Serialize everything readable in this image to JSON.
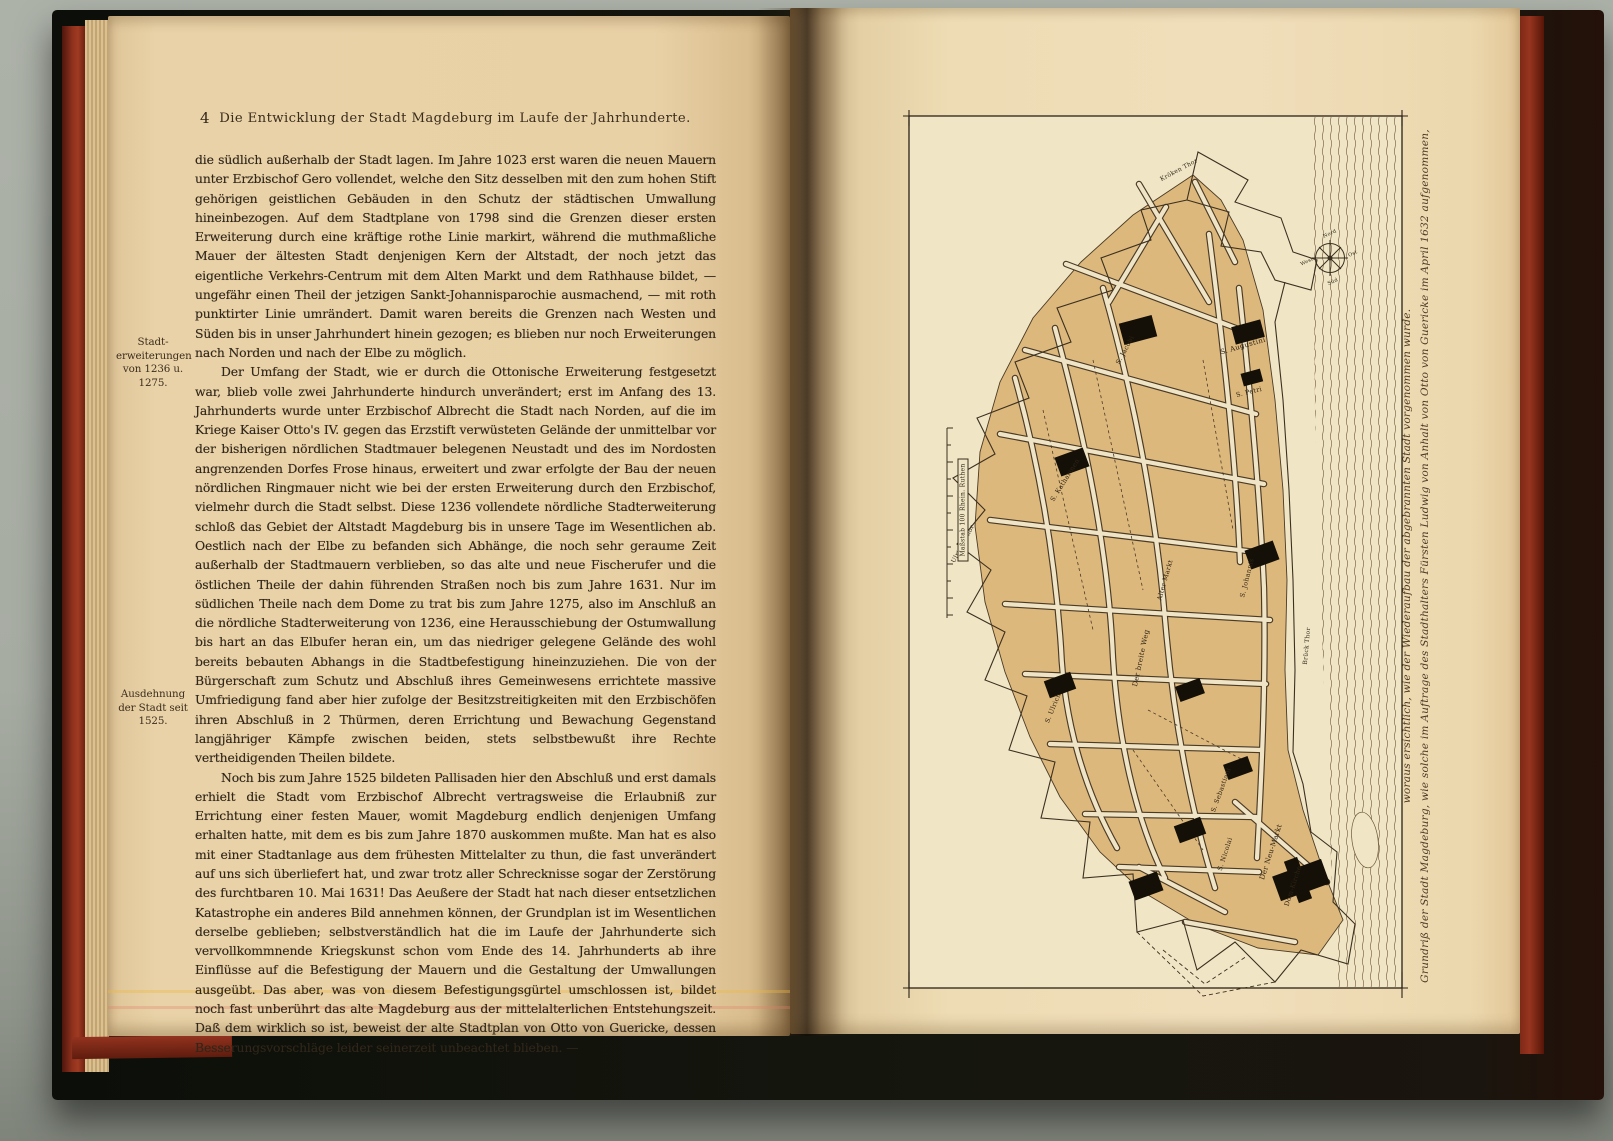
{
  "book": {
    "left_page": {
      "page_number": "4",
      "running_header": "Die Entwicklung der Stadt Magdeburg im Laufe der Jahrhunderte.",
      "margin_notes": [
        {
          "text": "Stadt-erweiterungen von 1236 u. 1275."
        },
        {
          "text": "Ausdehnung der Stadt seit 1525."
        }
      ],
      "paragraphs": [
        "die südlich außerhalb der Stadt lagen. Im Jahre 1023 erst waren die neuen Mauern unter Erzbischof Gero vollendet, welche den Sitz desselben mit den zum hohen Stift gehörigen geistlichen Gebäuden in den Schutz der städtischen Umwallung hineinbezogen. Auf dem Stadtplane von 1798 sind die Grenzen dieser ersten Erweiterung durch eine kräftige rothe Linie markirt, während die muthmaßliche Mauer der ältesten Stadt denjenigen Kern der Altstadt, der noch jetzt das eigentliche Verkehrs-Centrum mit dem Alten Markt und dem Rathhause bildet, — ungefähr einen Theil der jetzigen Sankt-Johannisparochie ausmachend, — mit roth punktirter Linie umrändert. Damit waren bereits die Grenzen nach Westen und Süden bis in unser Jahrhundert hinein gezogen; es blieben nur noch Erweiterungen nach Norden und nach der Elbe zu möglich.",
        "Der Umfang der Stadt, wie er durch die Ottonische Erweiterung festgesetzt war, blieb volle zwei Jahrhunderte hindurch unverändert; erst im Anfang des 13. Jahrhunderts wurde unter Erzbischof Albrecht die Stadt nach Norden, auf die im Kriege Kaiser Otto's IV. gegen das Erzstift verwüsteten Gelände der unmittelbar vor der bisherigen nördlichen Stadtmauer belegenen Neustadt und des im Nordosten angrenzenden Dorfes Frose hinaus, erweitert und zwar erfolgte der Bau der neuen nördlichen Ringmauer nicht wie bei der ersten Erweiterung durch den Erzbischof, vielmehr durch die Stadt selbst. Diese 1236 vollendete nördliche Stadterweiterung schloß das Gebiet der Altstadt Magdeburg bis in unsere Tage im Wesentlichen ab. Oestlich nach der Elbe zu befanden sich Abhänge, die noch sehr geraume Zeit außerhalb der Stadtmauern verblieben, so das alte und neue Fischerufer und die östlichen Theile der dahin führenden Straßen noch bis zum Jahre 1631. Nur im südlichen Theile nach dem Dome zu trat bis zum Jahre 1275, also im Anschluß an die nördliche Stadterweiterung von 1236, eine Herausschiebung der Ostumwallung bis hart an das Elbufer heran ein, um das niedriger gelegene Gelände des wohl bereits bebauten Abhangs in die Stadtbefestigung hineinzuziehen. Die von der Bürgerschaft zum Schutz und Abschluß ihres Gemeinwesens errichtete massive Umfriedigung fand aber hier zufolge der Besitzstreitigkeiten mit den Erzbischöfen ihren Abschluß in 2 Thürmen, deren Errichtung und Bewachung Gegenstand langjähriger Kämpfe zwischen beiden, stets selbstbewußt ihre Rechte vertheidigenden Theilen bildete.",
        "Noch bis zum Jahre 1525 bildeten Pallisaden hier den Abschluß und erst damals erhielt die Stadt vom Erzbischof Albrecht vertragsweise die Erlaubniß zur Errichtung einer festen Mauer, womit Magdeburg endlich denjenigen Umfang erhalten hatte, mit dem es bis zum Jahre 1870 auskommen mußte. Man hat es also mit einer Stadtanlage aus dem frühesten Mittelalter zu thun, die fast unverändert auf uns sich überliefert hat, und zwar trotz aller Schrecknisse sogar der Zerstörung des furchtbaren 10. Mai 1631! Das Aeußere der Stadt hat nach dieser entsetzlichen Katastrophe ein anderes Bild annehmen können, der Grundplan ist im Wesentlichen derselbe geblieben; selbstverständlich hat die im Laufe der Jahrhunderte sich vervollkommnende Kriegskunst schon vom Ende des 14. Jahrhunderts ab ihre Einflüsse auf die Befestigung der Mauern und die Gestaltung der Umwallungen ausgeübt. Das aber, was von diesem Befestigungsgürtel umschlossen ist, bildet noch fast unberührt das alte Magdeburg aus der mittelalterlichen Entstehungszeit. Daß dem wirklich so ist, beweist der alte Stadtplan von Otto von Guericke, dessen Besserungsvorschläge leider seinerzeit unbeachtet blieben. —"
      ]
    },
    "right_page": {
      "map": {
        "caption_line1": "Grundriß der Stadt Magdeburg, wie solche im Auftrage des Stadthalters Fürsten Ludwig von Anhalt von Otto von Guericke im April 1632 aufgenommen,",
        "caption_line2": "woraus ersichtlich, wie der Wiederaufbau der abgebrannten Stadt vorgenommen wurde.",
        "labels": [
          {
            "text": "S. Jacobi",
            "x": 222,
            "y": 240,
            "rot": -62,
            "size": 6.5
          },
          {
            "text": "S. Augustini",
            "x": 340,
            "y": 236,
            "rot": -16,
            "size": 7
          },
          {
            "text": "S. Petri",
            "x": 346,
            "y": 282,
            "rot": -14,
            "size": 6.5
          },
          {
            "text": "S. Katharinen",
            "x": 162,
            "y": 370,
            "rot": -58,
            "size": 6.5
          },
          {
            "text": "S. Johannis",
            "x": 344,
            "y": 468,
            "rot": -76,
            "size": 6.5
          },
          {
            "text": "Alter Markt",
            "x": 262,
            "y": 470,
            "rot": -74,
            "size": 6.5
          },
          {
            "text": "Der breite Weg",
            "x": 238,
            "y": 548,
            "rot": -78,
            "size": 7
          },
          {
            "text": "S. Ulrich",
            "x": 150,
            "y": 598,
            "rot": -68,
            "size": 6.5
          },
          {
            "text": "S. Sebastiani",
            "x": 318,
            "y": 680,
            "rot": -70,
            "size": 6.5
          },
          {
            "text": "S. Nicolai",
            "x": 322,
            "y": 744,
            "rot": -72,
            "size": 6.5
          },
          {
            "text": "Der Neu-Markt",
            "x": 368,
            "y": 742,
            "rot": -72,
            "size": 7
          },
          {
            "text": "Dom-Kirche",
            "x": 390,
            "y": 776,
            "rot": -72,
            "size": 6.5
          },
          {
            "text": "Ulrichs Thor",
            "x": 60,
            "y": 434,
            "rot": -62,
            "size": 6
          },
          {
            "text": "Brück Thor",
            "x": 404,
            "y": 536,
            "rot": -85,
            "size": 6
          },
          {
            "text": "Kröken Thor",
            "x": 276,
            "y": 60,
            "rot": -28,
            "size": 6
          },
          {
            "text": "Maßstab 100 Rhein. Ruthen",
            "x": 60,
            "y": 400,
            "rot": -90,
            "size": 6,
            "box": true
          },
          {
            "text": "Nord",
            "x": 427,
            "y": 124,
            "rot": -25,
            "size": 5
          },
          {
            "text": "Ost",
            "x": 450,
            "y": 144,
            "rot": -25,
            "size": 5
          },
          {
            "text": "Süd",
            "x": 430,
            "y": 172,
            "rot": -25,
            "size": 5
          },
          {
            "text": "West",
            "x": 404,
            "y": 152,
            "rot": -25,
            "size": 5
          }
        ]
      }
    },
    "colors": {
      "left_paper": "#e9d1a6",
      "right_paper": "#eedcb4",
      "map_paper": "#f0e6c6",
      "city_block_tan": "#ddb87c",
      "cover_black": "#14160e",
      "page_edge_red": "#8f311d",
      "ink": "#30261a"
    }
  }
}
